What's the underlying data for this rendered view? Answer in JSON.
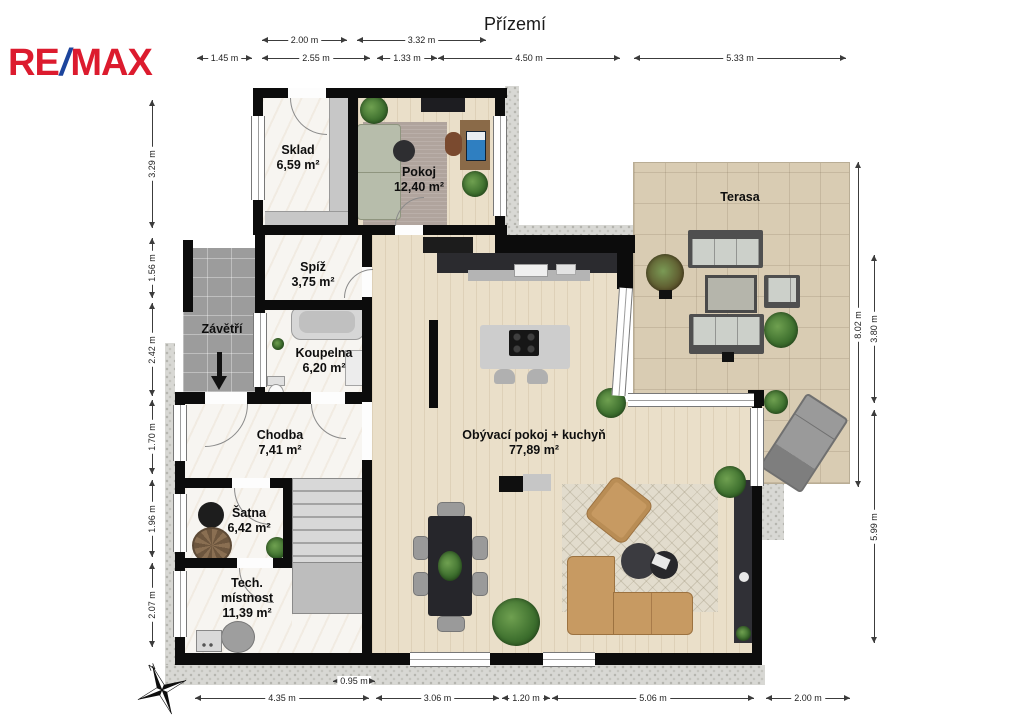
{
  "brand": {
    "re": "RE",
    "slash": "/",
    "max": "MAX",
    "red": "#dc1b2e",
    "blue": "#1c449c"
  },
  "title": "Přízemí",
  "compass_label": "N",
  "rooms": {
    "sklad": {
      "name": "Sklad",
      "area": "6,59 m²"
    },
    "pokoj": {
      "name": "Pokoj",
      "area": "12,40 m²"
    },
    "spiz": {
      "name": "Spíž",
      "area": "3,75 m²"
    },
    "zavetri": {
      "name": "Závětří",
      "area": ""
    },
    "koupelna": {
      "name": "Koupelna",
      "area": "6,20 m²"
    },
    "chodba": {
      "name": "Chodba",
      "area": "7,41 m²"
    },
    "satna": {
      "name": "Šatna",
      "area": "6,42 m²"
    },
    "tech_mistnost": {
      "name": "Tech. místnost",
      "area": "11,39 m²"
    },
    "obyvaci_pokoj": {
      "name": "Obývací pokoj + kuchyň",
      "area": "77,89 m²"
    },
    "terasa": {
      "name": "Terasa",
      "area": ""
    }
  },
  "dimensions": {
    "top_row1": [
      "2.00 m",
      "3.32 m"
    ],
    "top_row2": [
      "1.45 m",
      "2.55 m",
      "1.33 m",
      "4.50 m",
      "5.33 m"
    ],
    "left": [
      "3.29 m",
      "1.56 m",
      "2.42 m",
      "1.70 m",
      "1.96 m",
      "2.07 m"
    ],
    "right": [
      "8.02 m",
      "3.80 m",
      "5.99 m"
    ],
    "bottom_mini": [
      "0.95 m"
    ],
    "bottom": [
      "4.35 m",
      "3.06 m",
      "1.20 m",
      "5.06 m",
      "2.00 m"
    ]
  }
}
